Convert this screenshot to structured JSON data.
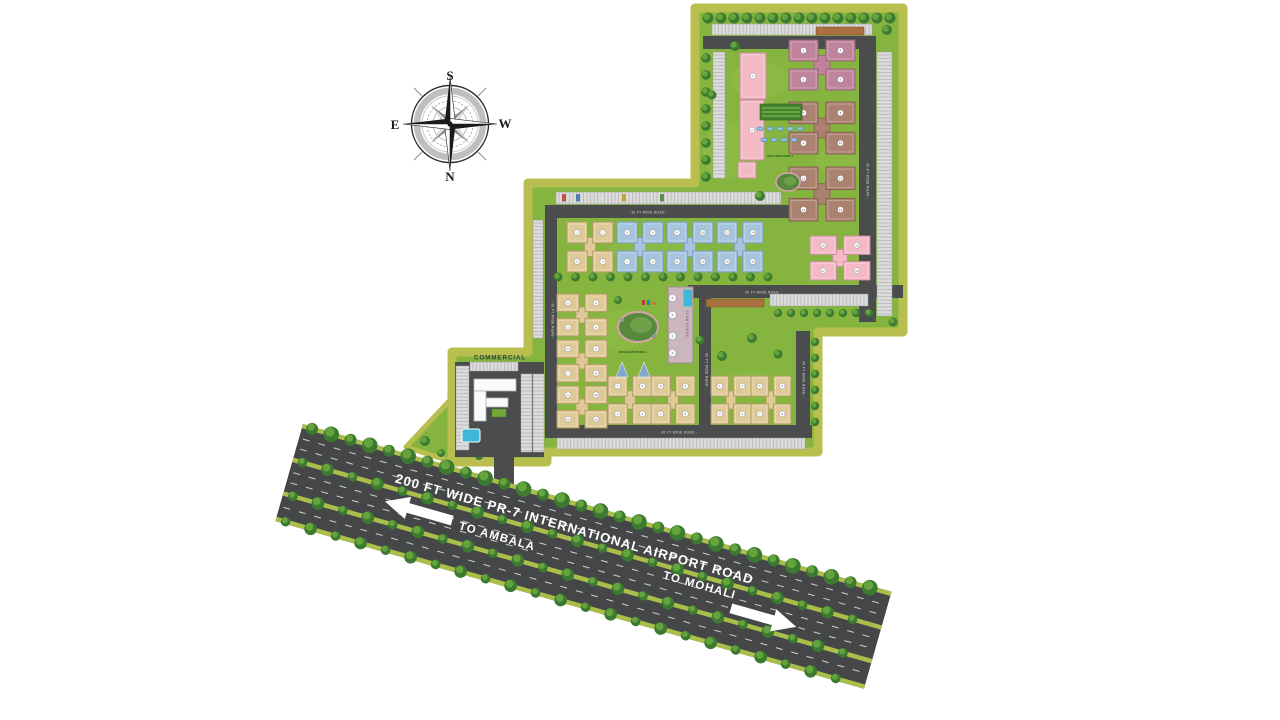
{
  "page": {
    "background": "#ffffff"
  },
  "compass": {
    "top": "S",
    "right": "W",
    "bottom": "N",
    "left": "E"
  },
  "site": {
    "labels": {
      "commercial": "COMMERCIAL",
      "club_house": "CLUB HOUSE",
      "internal_road": "30 FT WIDE ROAD",
      "park_1": "ORCHARD PARK-1",
      "park_2": "ORCHARD PARK-2"
    },
    "colors": {
      "border": "#b8bf4e",
      "lawn": "#85b53f",
      "lawn_light": "#a6cf5a",
      "road": "#4b4c4e",
      "hatch_bg": "#dcdcdc",
      "hatch_line": "#9b9b9b",
      "highway": "#454647",
      "median": "#a9bf4a",
      "tree_dark": "#3c7a31",
      "tree_light": "#69a93e",
      "planter": "#a9713f",
      "pool": "#3eb8d8",
      "pink": "#f3bac6",
      "pink_dark": "#cf8ea0",
      "mauve": "#bf849b",
      "mauve_dark": "#996377",
      "brown": "#ab8170",
      "brown_dark": "#84604f",
      "blue": "#a7c4de",
      "blue_dark": "#7a9fc0",
      "tan": "#dfca97",
      "tan_dark": "#b29a62",
      "club": "#cbb6bd",
      "club_dark": "#a18b94"
    },
    "clusters": [
      {
        "type": "slab",
        "x": 753,
        "y": 76,
        "w": 26,
        "h": 46,
        "color": "pink",
        "blocks": [
          "1"
        ]
      },
      {
        "type": "slab",
        "x": 752,
        "y": 130,
        "w": 24,
        "h": 60,
        "color": "pink",
        "blocks": [
          "2"
        ]
      },
      {
        "type": "slab",
        "x": 747,
        "y": 170,
        "w": 18,
        "h": 16,
        "color": "pink",
        "blocks": [
          ""
        ]
      },
      {
        "type": "quad",
        "x": 822,
        "y": 65,
        "w": 66,
        "h": 50,
        "color": "mauve",
        "blocks": [
          "3",
          "4",
          "5",
          "6"
        ]
      },
      {
        "type": "quad",
        "x": 822,
        "y": 128,
        "w": 66,
        "h": 52,
        "color": "brown",
        "blocks": [
          "7",
          "8",
          "9",
          "10"
        ]
      },
      {
        "type": "quad",
        "x": 822,
        "y": 194,
        "w": 66,
        "h": 54,
        "color": "brown",
        "blocks": [
          "11",
          "12",
          "13",
          "14"
        ]
      },
      {
        "type": "quad",
        "x": 840,
        "y": 258,
        "w": 60,
        "h": 44,
        "color": "pink",
        "blocks": [
          "15",
          "16",
          "17",
          "18"
        ]
      },
      {
        "type": "quad",
        "x": 590,
        "y": 247,
        "w": 46,
        "h": 50,
        "color": "tan",
        "blocks": [
          "1",
          "2",
          "3",
          "4"
        ]
      },
      {
        "type": "quad",
        "x": 640,
        "y": 247,
        "w": 46,
        "h": 50,
        "color": "blue",
        "blocks": [
          "5",
          "6",
          "7",
          "8"
        ]
      },
      {
        "type": "quad",
        "x": 690,
        "y": 247,
        "w": 46,
        "h": 50,
        "color": "blue",
        "blocks": [
          "9",
          "10",
          "11",
          "12"
        ]
      },
      {
        "type": "quad",
        "x": 740,
        "y": 247,
        "w": 46,
        "h": 50,
        "color": "blue",
        "blocks": [
          "13",
          "14",
          "15",
          "16"
        ]
      },
      {
        "type": "quad",
        "x": 582,
        "y": 315,
        "w": 50,
        "h": 42,
        "color": "tan",
        "blocks": [
          "1",
          "2",
          "3",
          "4"
        ]
      },
      {
        "type": "quad",
        "x": 582,
        "y": 361,
        "w": 50,
        "h": 42,
        "color": "tan",
        "blocks": [
          "5",
          "6",
          "7",
          "8"
        ]
      },
      {
        "type": "quad",
        "x": 582,
        "y": 407,
        "w": 50,
        "h": 42,
        "color": "tan",
        "blocks": [
          "9",
          "10",
          "11",
          "12"
        ]
      },
      {
        "type": "quad",
        "x": 630,
        "y": 400,
        "w": 44,
        "h": 48,
        "color": "tan",
        "blocks": [
          "1",
          "2",
          "3",
          "4"
        ]
      },
      {
        "type": "quad",
        "x": 673,
        "y": 400,
        "w": 44,
        "h": 48,
        "color": "tan",
        "blocks": [
          "5",
          "6",
          "7",
          "8"
        ]
      },
      {
        "type": "quad",
        "x": 731,
        "y": 400,
        "w": 40,
        "h": 48,
        "color": "tan",
        "blocks": [
          "1",
          "2",
          "3",
          "4"
        ]
      },
      {
        "type": "quad",
        "x": 771,
        "y": 400,
        "w": 40,
        "h": 48,
        "color": "tan",
        "blocks": [
          "5",
          "6",
          "7",
          "8"
        ]
      }
    ]
  },
  "highway": {
    "name": "200 FT WIDE PR-7 INTERNATIONAL AIRPORT ROAD",
    "direction_left": "TO AMBALA",
    "direction_right": "TO MOHALI"
  }
}
